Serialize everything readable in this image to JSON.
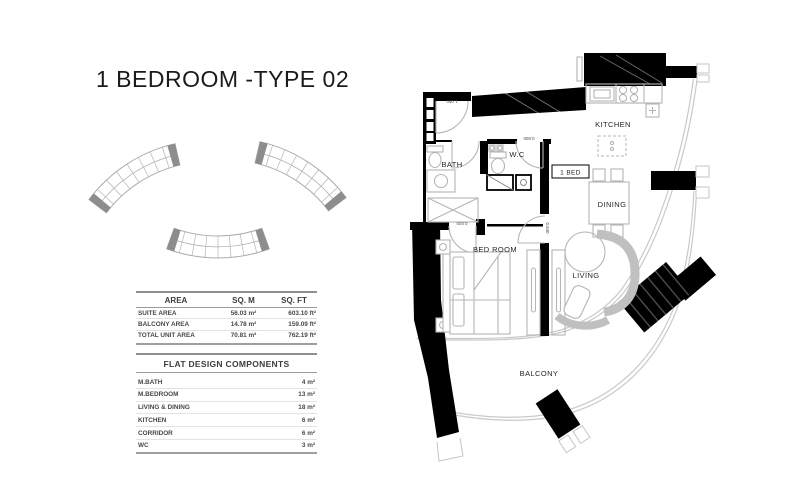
{
  "title": "1 BEDROOM -TYPE 02",
  "area_table": {
    "headers": {
      "area": "AREA",
      "sqm": "SQ. M",
      "sqft": "SQ. FT"
    },
    "rows": [
      {
        "name": "SUITE AREA",
        "sqm": "56.03 m²",
        "sqft": "603.10 ft²"
      },
      {
        "name": "BALCONY AREA",
        "sqm": "14.78 m²",
        "sqft": "159.09 ft²"
      },
      {
        "name": "TOTAL UNIT AREA",
        "sqm": "70.81 m²",
        "sqft": "762.19 ft²"
      }
    ]
  },
  "components_table": {
    "title": "FLAT DESIGN COMPONENTS",
    "rows": [
      {
        "name": "M.BATH",
        "value": "4 m²"
      },
      {
        "name": "M.BEDROOM",
        "value": "13 m²"
      },
      {
        "name": "LIVING & DINING",
        "value": "18 m²"
      },
      {
        "name": "KITCHEN",
        "value": "6 m²"
      },
      {
        "name": "CORRIDOR",
        "value": "6 m²"
      },
      {
        "name": "WC",
        "value": "3 m²"
      }
    ]
  },
  "plan": {
    "labels": {
      "kitchen": "KITCHEN",
      "bath": "BATH",
      "wc": "W.C",
      "bed_tag": "1 BED",
      "dining": "DINING",
      "bedroom": "BED ROOM",
      "living": "LIVING",
      "balcony": "BALCONY"
    },
    "dims": {
      "entrance_door": "1.050",
      "wc_door": "0.800",
      "bedroom_door": "0.920",
      "living_door": "0.940"
    },
    "colors": {
      "wall": "#000000",
      "furniture_line": "#b5b5b5",
      "glazing_line": "#c9c9c9",
      "label_text": "#262626"
    }
  }
}
